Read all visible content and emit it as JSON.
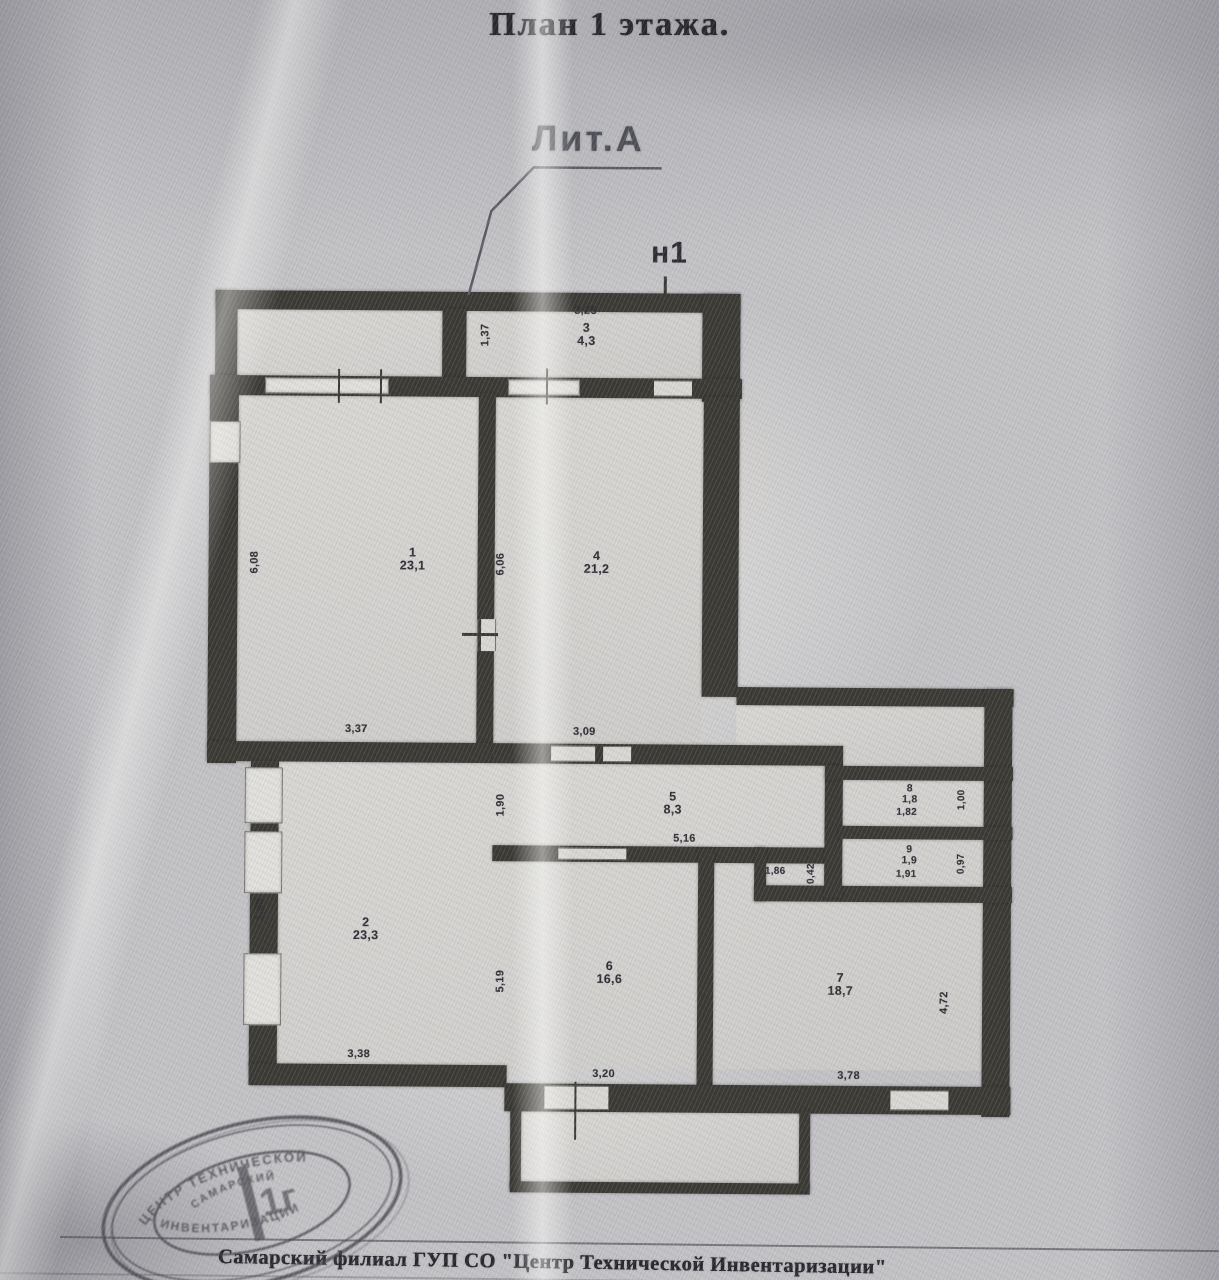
{
  "page_title": "План 1 этажа.",
  "plan": {
    "liter_label": "Лит.А",
    "part_label": "н1"
  },
  "rooms": {
    "r1": {
      "num": "1",
      "area": "23,1"
    },
    "r2": {
      "num": "2",
      "area": "23,3"
    },
    "r3": {
      "num": "3",
      "area": "4,3"
    },
    "r4": {
      "num": "4",
      "area": "21,2"
    },
    "r5": {
      "num": "5",
      "area": "8,3"
    },
    "r6": {
      "num": "6",
      "area": "16,6"
    },
    "r7": {
      "num": "7",
      "area": "18,7"
    },
    "r8": {
      "num": "8",
      "area": "1,8"
    },
    "r9": {
      "num": "9",
      "area": "1,9"
    }
  },
  "dims": {
    "vest_w": "3,25",
    "vest_h": "1,37",
    "r1_h": "6,08",
    "r1_w": "3,37",
    "r4_h": "6,06",
    "r4_w": "3,09",
    "r5_w": "5,16",
    "r5_h": "1,90",
    "r8_w": "1,82",
    "r8_h": "1,00",
    "r9_w": "1,91",
    "r9_h": "0,97",
    "niche_w": "1,86",
    "niche_h": "0,42",
    "r2_h": "1,68",
    "r2_w": "3,38",
    "r6_h": "5,19",
    "r6_w": "3,20",
    "r7_h": "4,72",
    "r7_w": "3,78"
  },
  "stamp": {
    "arc_top": "ЦЕНТР ТЕХНИЧЕСКОЙ",
    "arc_bottom": "ИНВЕНТАРИЗАЦИИ",
    "inner_arc": "САМАРСКИЙ",
    "center": "1г"
  },
  "footer": {
    "org_line": "Самарский филиал  ГУП  СО  \"Центр Технической Инвентаризации\""
  }
}
